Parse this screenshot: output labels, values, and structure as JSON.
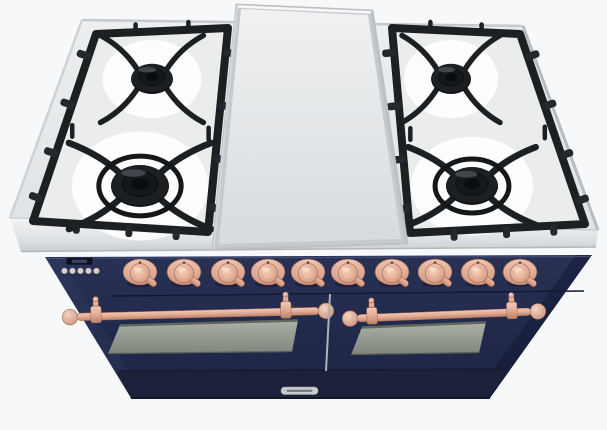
{
  "scene": {
    "description": "Three-quarter overhead product render of a freestanding double-oven range: stainless five-point gas cooktop with center griddle plate, midnight-navy front with copper knobs and copper towel-bar door handles",
    "background_color": "#f7f8fa"
  },
  "colors": {
    "background": "#f7f8fa",
    "steel_top": "#e7e9ea",
    "steel_edge": "#c6c9cc",
    "enamel": "#ebedec",
    "grate": "#24272b",
    "grate_dark": "#1d2023",
    "body_navy": "#222a4d",
    "kick_navy": "#1b2138",
    "groove": "#141a30",
    "copper": "#e7b19c",
    "copper_dark": "#c08a72",
    "window_top": "#adb1a8",
    "window_bottom": "#7f857b",
    "door_divider": "#aeb2b5",
    "display_bg": "#0e1220",
    "badge_plate": "#c9ccce"
  },
  "cooktop": {
    "griddle": {
      "name": "center-griddle-plate"
    },
    "burner_count": 4,
    "burners": [
      {
        "name": "left-rear-burner",
        "cx": 152,
        "cy": 79,
        "rx": 21,
        "ry": 15,
        "ring": false
      },
      {
        "name": "left-front-burner",
        "cx": 140,
        "cy": 186,
        "rx": 29,
        "ry": 21,
        "ring": true
      },
      {
        "name": "right-rear-burner",
        "cx": 451,
        "cy": 79,
        "rx": 20,
        "ry": 15,
        "ring": false
      },
      {
        "name": "right-front-burner",
        "cx": 472,
        "cy": 186,
        "rx": 26,
        "ry": 19,
        "ring": true
      }
    ]
  },
  "control_panel": {
    "knob_count": 10,
    "knobs_x": [
      140,
      184,
      228,
      268,
      308,
      348,
      392,
      435,
      478,
      520
    ],
    "knob_y": 272,
    "display": {
      "legible": false
    },
    "button_count": 5,
    "buttons_x": [
      64.5,
      72.5,
      80.5,
      88.5,
      96.5
    ],
    "button_y": 271
  },
  "doors": {
    "count": 2,
    "items": [
      {
        "name": "left-oven-door"
      },
      {
        "name": "right-oven-door"
      }
    ]
  },
  "badge": {
    "name": "brand-badge",
    "legible": false
  }
}
